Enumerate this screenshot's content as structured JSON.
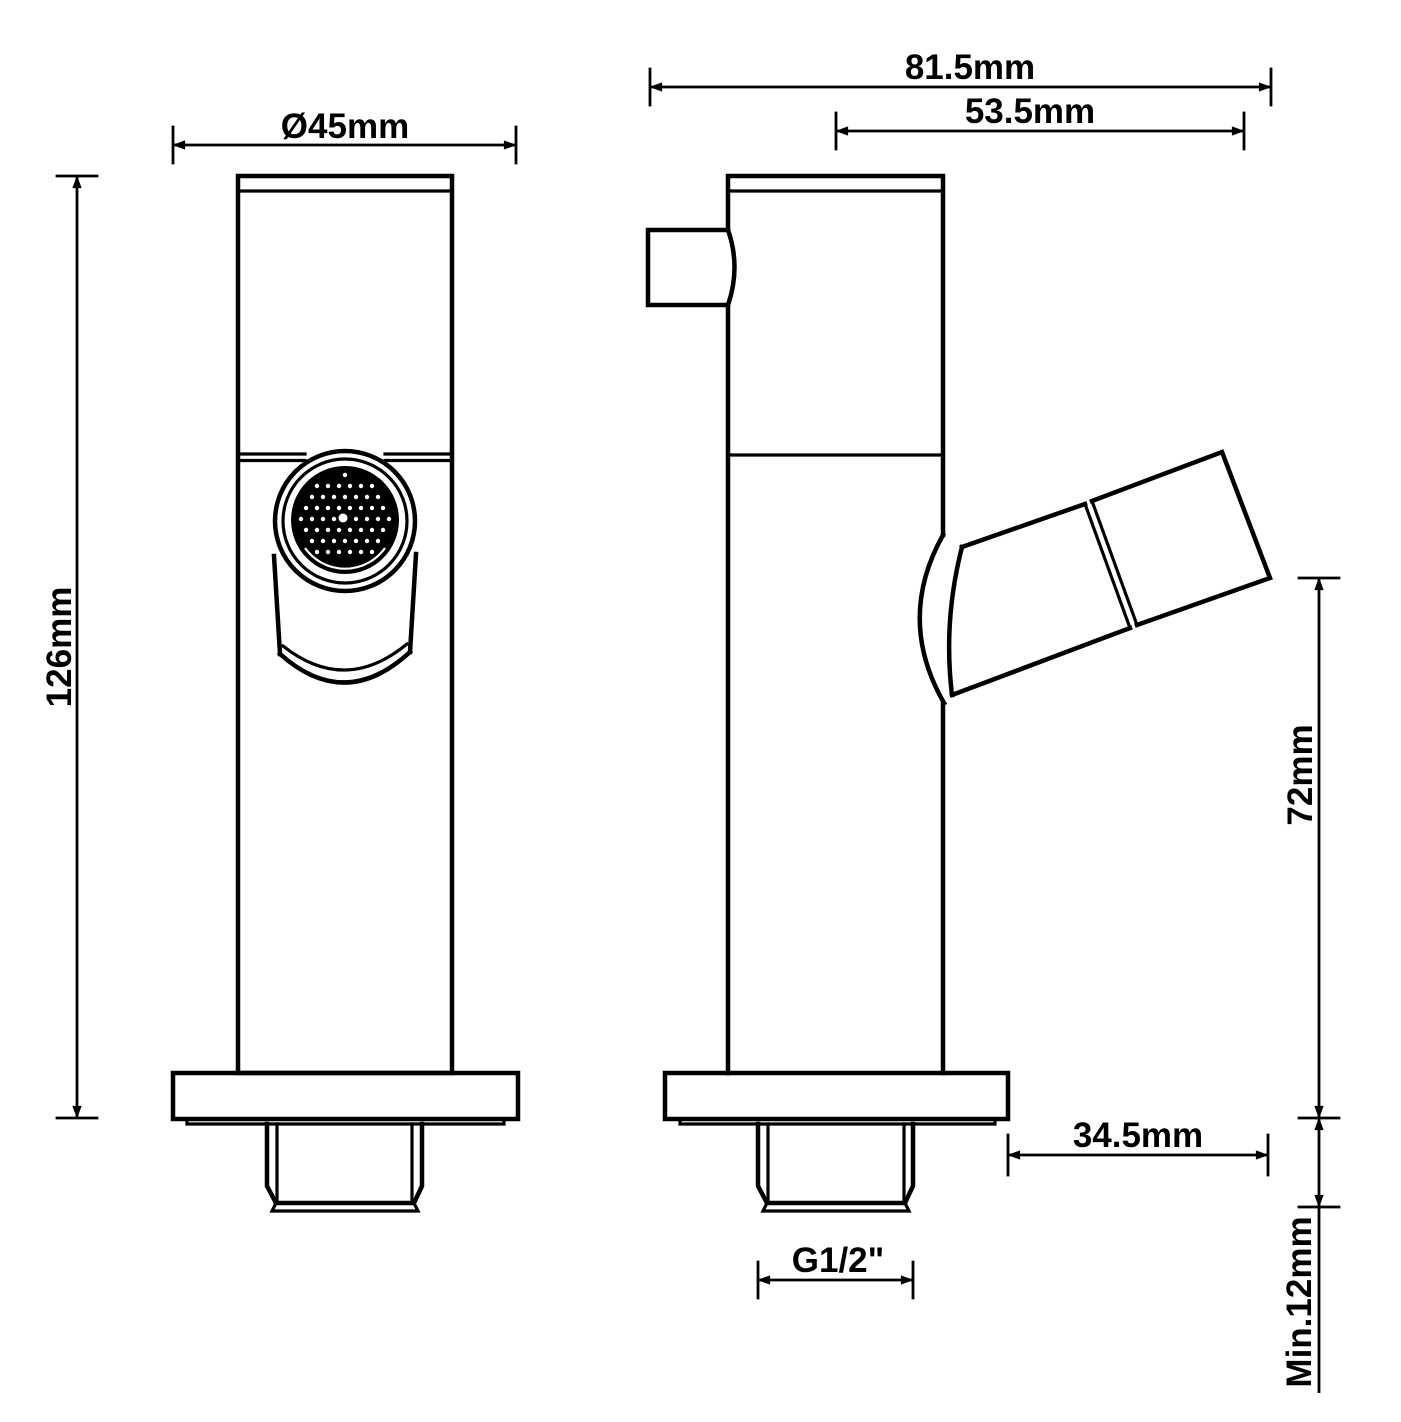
{
  "colors": {
    "line": "#000000",
    "background": "#ffffff"
  },
  "drawing": {
    "front_view": {
      "diameter_label": "Ø45mm",
      "height_label": "126mm"
    },
    "side_view": {
      "depth_label": "81.5mm",
      "spout_reach_label": "53.5mm",
      "spout_height_label": "72mm",
      "spout_offset_label": "34.5mm",
      "thread_length_label": "Min.12mm",
      "thread_size_label": "G1/2\""
    }
  }
}
